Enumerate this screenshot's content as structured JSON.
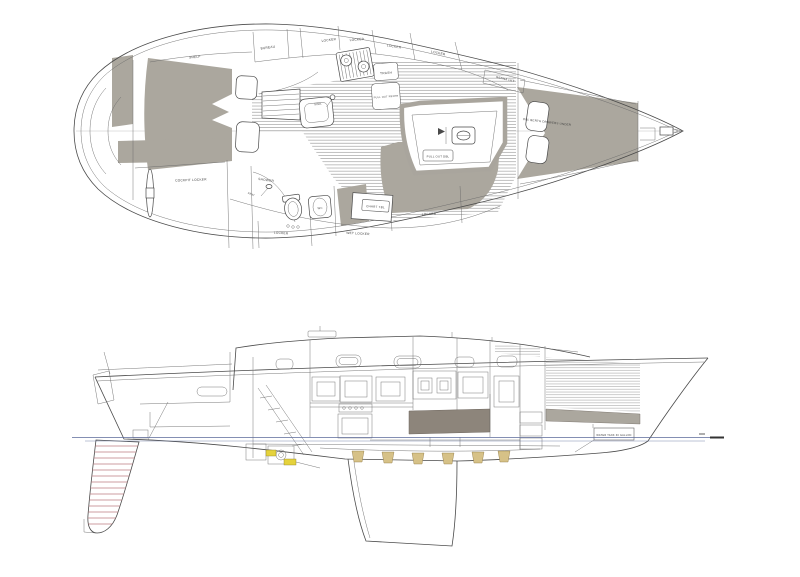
{
  "drawing": {
    "type": "sailboat arrangement drawing",
    "views": {
      "top": "interior arrangement plan",
      "bottom": "inboard profile"
    }
  },
  "plan_view": {
    "labels": {
      "shelf": "SHELF",
      "bureau": "BUREAU",
      "locker_1": "LOCKER",
      "locker_2": "LOCKER",
      "locker_3": "LOCKER",
      "locker_4": "LOCKER",
      "trash": "TRASH",
      "pull_out_refer": "PULL OUT REFER",
      "genna_lkt": "GENNA LKT",
      "dbl_berth": "DBL BERTH DRAWERS UNDER",
      "cockpit_locker": "COCKPIT LOCKER",
      "shower": "SHOWER",
      "seat": "SEAT",
      "sink": "SINK",
      "wc": "WC",
      "chart_tbl": "CHART TBL",
      "locker_aft": "LOCKER",
      "wet_locker": "WET LOCKER",
      "locker_salon": "LOCKER",
      "pull_out_dbl": "PULL OUT DBL"
    }
  },
  "profile_view": {
    "labels": {
      "water_tank": "WATER TANK 30 GALLON"
    }
  },
  "colors": {
    "line": "#4a4a4a",
    "berth_fill": "#aba79e",
    "settee_fill": "#8d857b",
    "rudder_contour": "#bc7e80",
    "waterline": "#5b6a9a",
    "frame_fill": "#d6c187",
    "engine_accent": "#e5d23c"
  }
}
